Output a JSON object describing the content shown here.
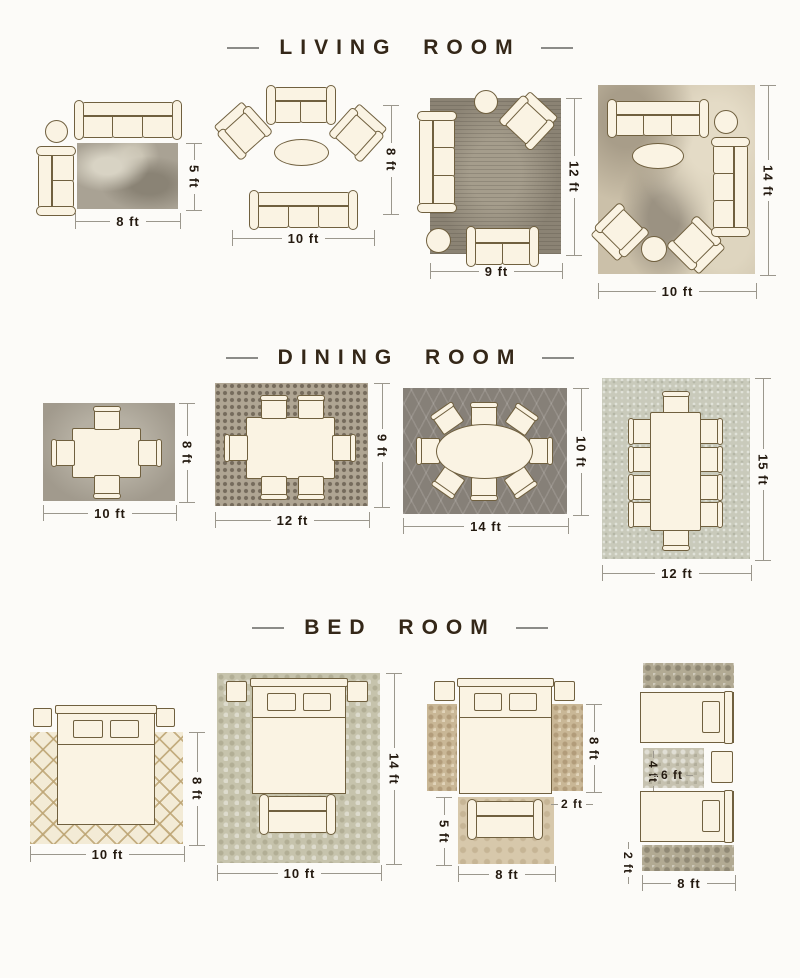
{
  "colors": {
    "background": "#fcfbf8",
    "title_text": "#342718",
    "dimension_text": "#241a10",
    "furniture_fill": "#faf3e3",
    "furniture_outline": "#70603f"
  },
  "sections": {
    "living": {
      "title": "LIVING ROOM",
      "layouts": [
        {
          "width_label": "8 ft",
          "height_label": "5 ft"
        },
        {
          "width_label": "10 ft",
          "height_label": "8 ft"
        },
        {
          "width_label": "9 ft",
          "height_label": "12 ft"
        },
        {
          "width_label": "10 ft",
          "height_label": "14 ft"
        }
      ]
    },
    "dining": {
      "title": "DINING ROOM",
      "layouts": [
        {
          "width_label": "10 ft",
          "height_label": "8 ft"
        },
        {
          "width_label": "12 ft",
          "height_label": "9 ft"
        },
        {
          "width_label": "14 ft",
          "height_label": "10 ft"
        },
        {
          "width_label": "12 ft",
          "height_label": "15 ft"
        }
      ]
    },
    "bedroom": {
      "title": "BED ROOM",
      "layouts": [
        {
          "width_label": "10 ft",
          "height_label": "8 ft"
        },
        {
          "width_label": "10 ft",
          "height_label": "14 ft"
        },
        {
          "runner_height_label": "8 ft",
          "runner_width_label": "2 ft",
          "foot_rug_height_label": "5 ft",
          "foot_rug_width_label": "8 ft"
        },
        {
          "mid_rug_height_label": "4 ft",
          "mid_rug_width_label": "6 ft",
          "runner_width_label": "2 ft",
          "runner_length_label": "8 ft"
        }
      ]
    }
  }
}
